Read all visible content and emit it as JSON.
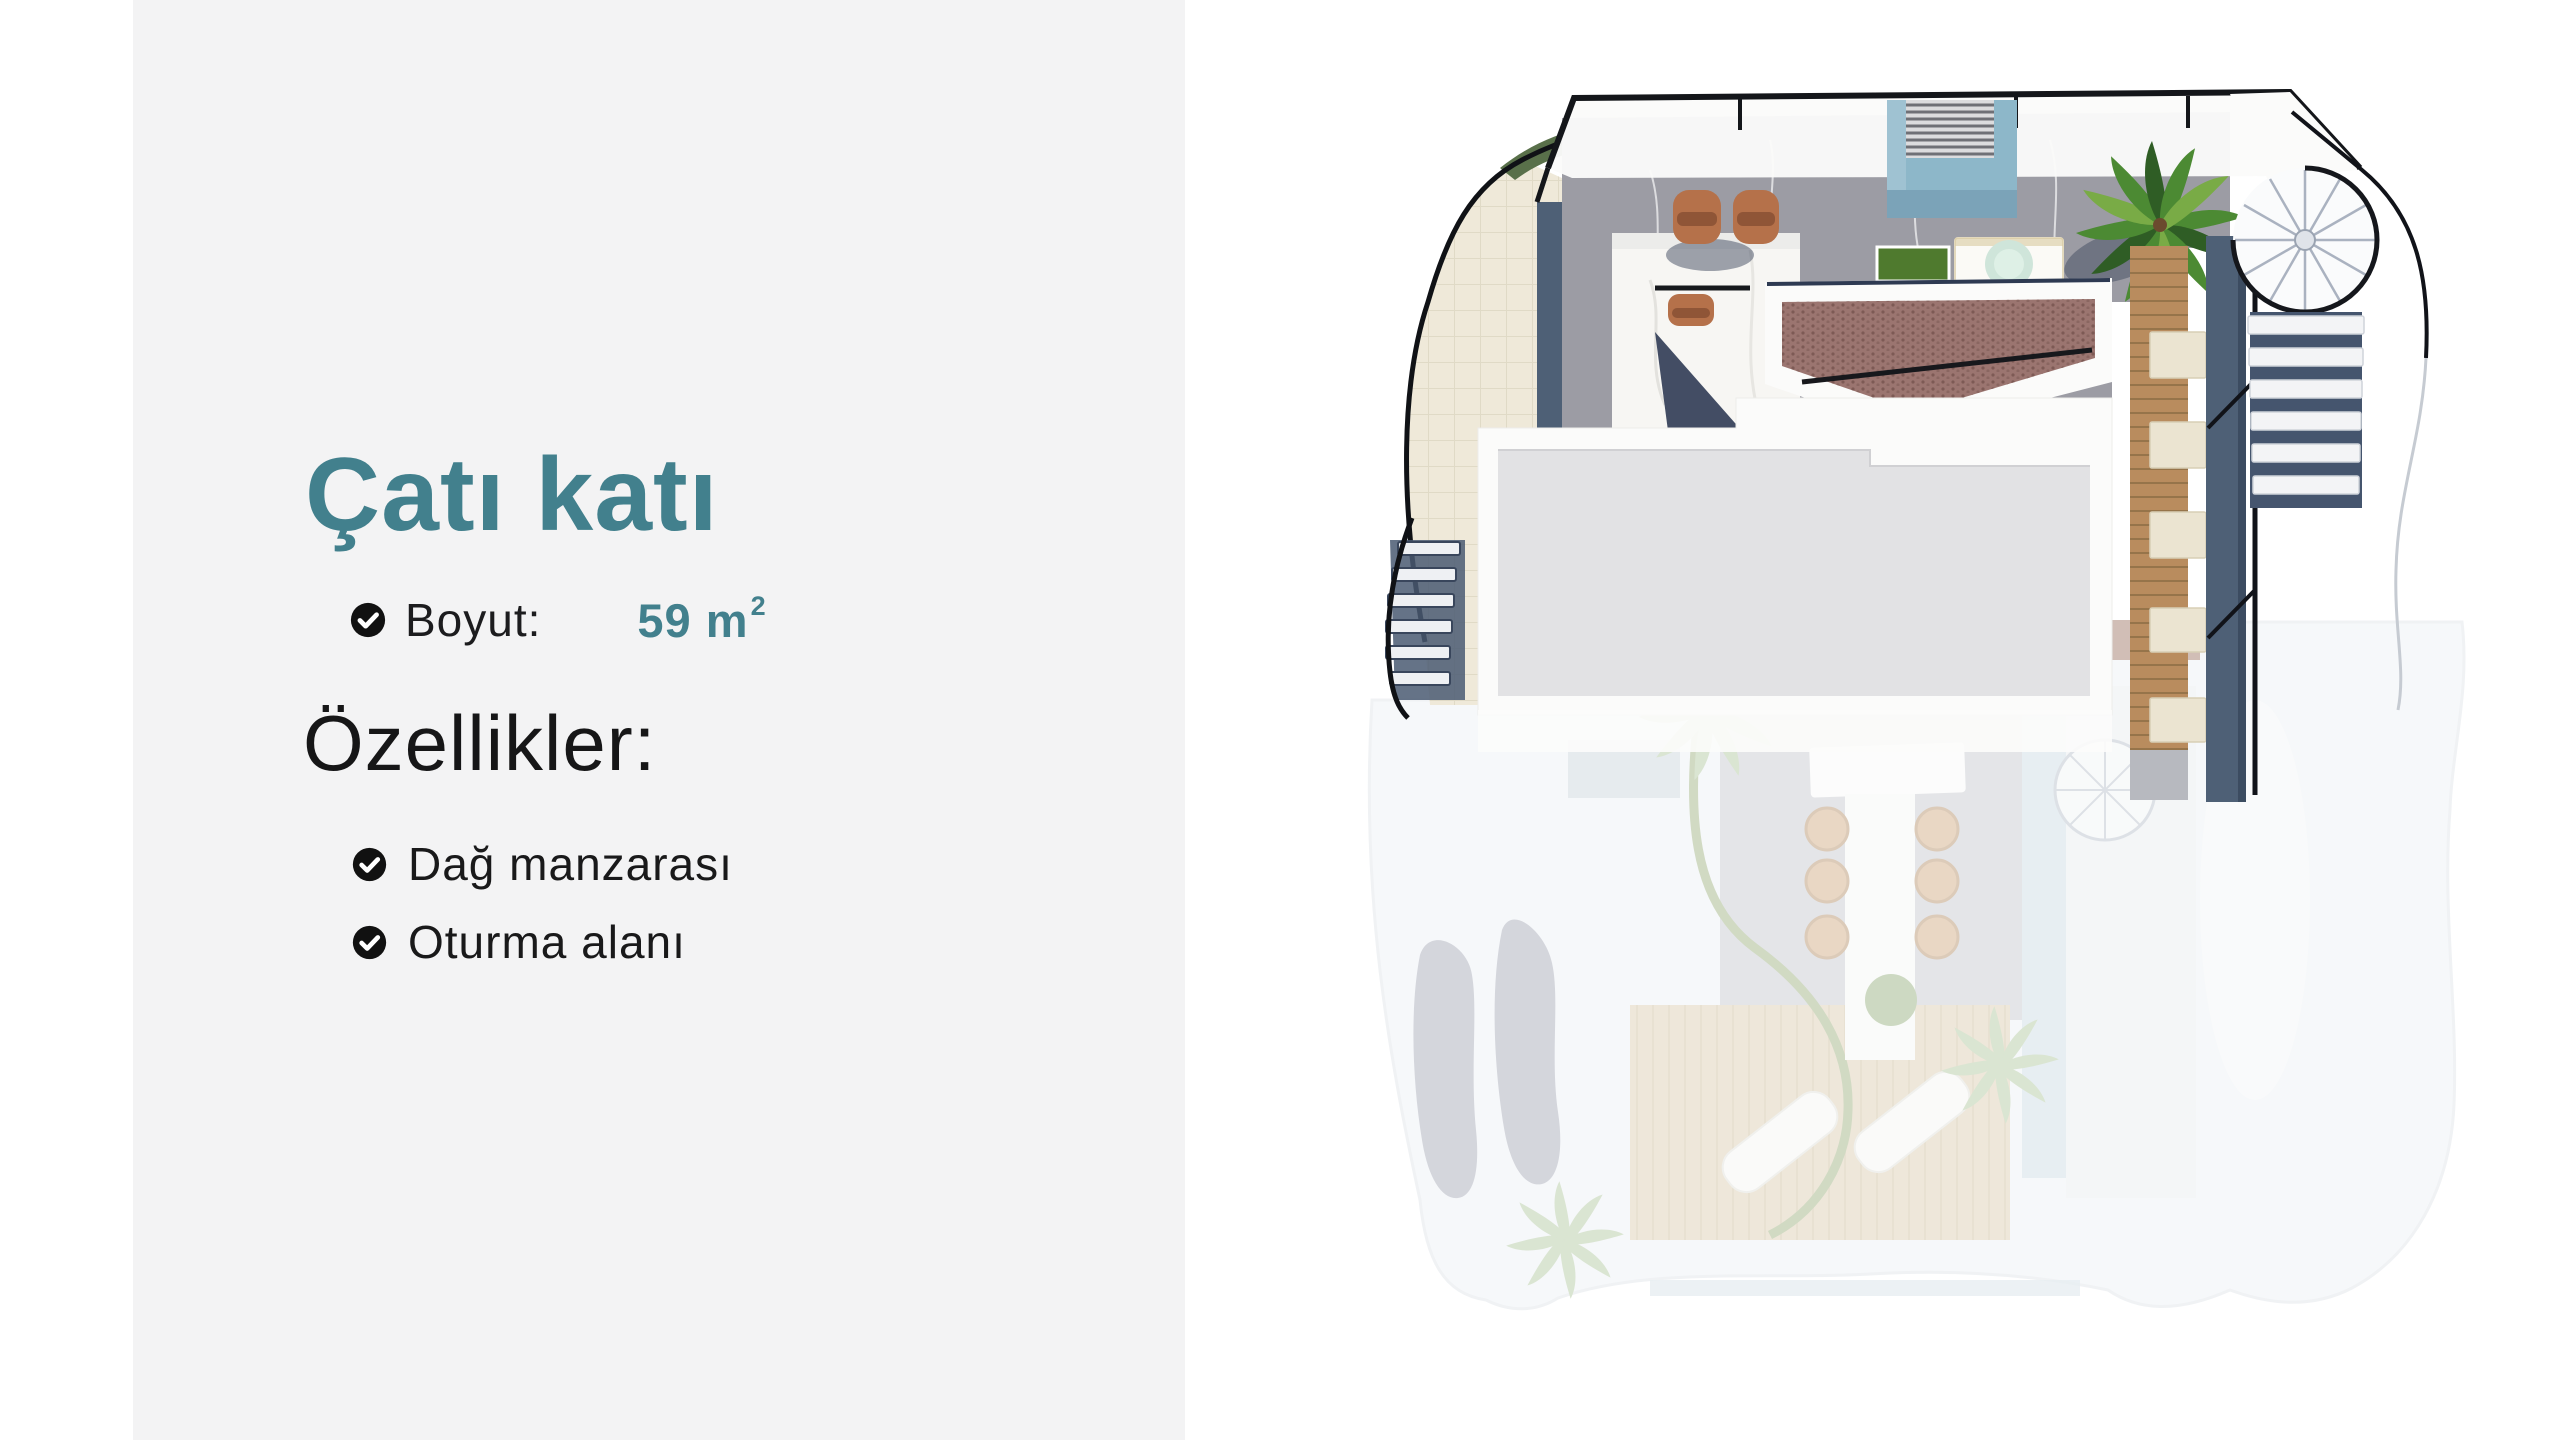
{
  "page": {
    "background_color": "#ffffff",
    "panel_color": "#f3f3f4"
  },
  "theme": {
    "accent_teal": "#42808d",
    "text_black": "#1c1c1e",
    "check_icon_color": "#111111"
  },
  "info": {
    "title": "Çatı katı",
    "size_row": {
      "label": "Boyut:",
      "value": "59 m",
      "superscript": "2"
    },
    "features_heading": "Özellikler:",
    "features": [
      {
        "label": "Dağ manzarası"
      },
      {
        "label": "Oturma alanı"
      }
    ]
  },
  "floor_plan": {
    "colors": {
      "marble_gray": "#9c9ca4",
      "stair_blue": "#8db7c9",
      "stair_blue_front": "#7ba3b8",
      "lounger_terracotta": "#b5714a",
      "grass_green": "#4f7a2e",
      "palm_green": "#4c8a33",
      "wood_deck": "#b98c5e",
      "navy_wall": "#4e6076",
      "outline_black": "#14161a",
      "roof_white": "#fbfbfa",
      "roof_inset_gray": "#e2e2e4",
      "tile_brown": "#9b7570",
      "cream_tile": "#efe9d9",
      "hedge_green": "#59704a",
      "jacuzzi_aqua": "#cfe5da",
      "faded_wash": "#e9edf2",
      "faded_shape_gray": "#9297a8",
      "faded_patio_gray": "#bcbfc6",
      "faded_wood": "#d4c3a1",
      "faded_palm": "#a3bd8e",
      "rattan_chair": "#c89a6b",
      "pool_blue": "#c3d5df"
    }
  }
}
